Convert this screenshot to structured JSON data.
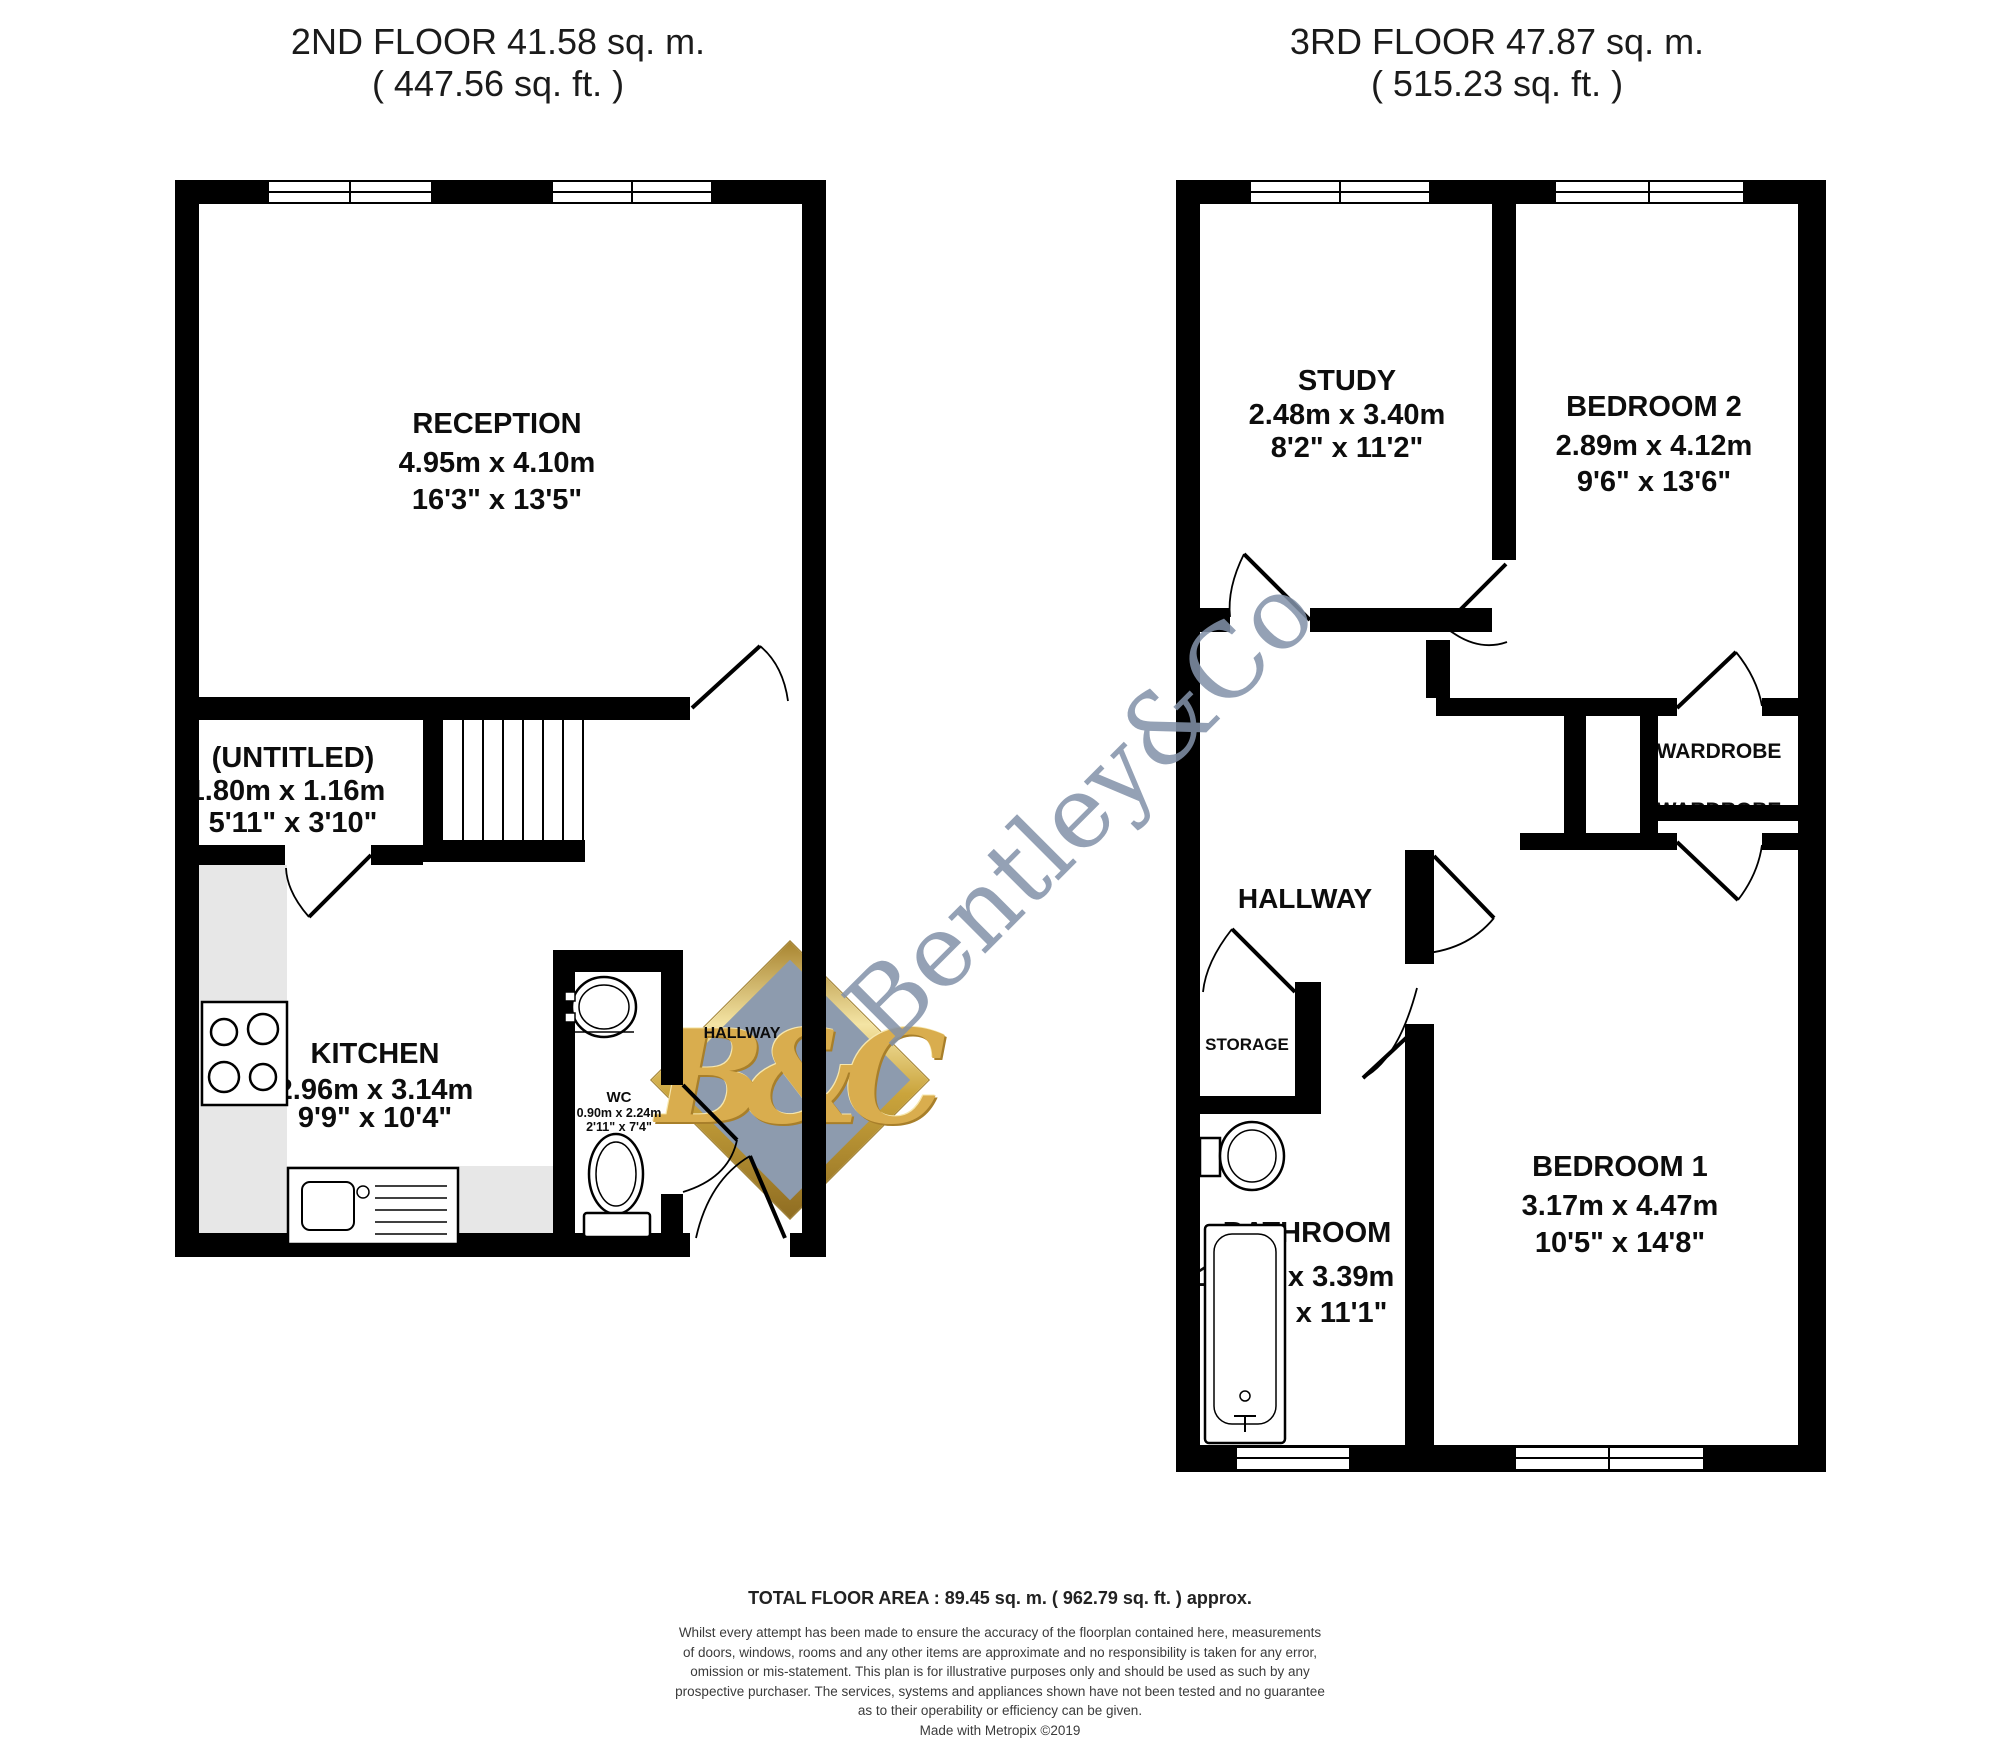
{
  "floor2": {
    "title": "2ND FLOOR 41.58 sq. m.",
    "subtitle": "( 447.56 sq. ft. )",
    "rooms": {
      "reception": {
        "name": "RECEPTION",
        "metric": "4.95m x 4.10m",
        "imperial": "16'3\" x 13'5\""
      },
      "untitled": {
        "name": "(UNTITLED)",
        "metric": "1.80m x 1.16m",
        "imperial": "5'11\" x 3'10\""
      },
      "kitchen": {
        "name": "KITCHEN",
        "metric": "2.96m x 3.14m",
        "imperial": "9'9\" x 10'4\""
      },
      "wc": {
        "name": "WC",
        "metric": "0.90m x 2.24m",
        "imperial": "2'11\" x 7'4\""
      },
      "hallway": {
        "name": "HALLWAY"
      }
    }
  },
  "floor3": {
    "title": "3RD FLOOR 47.87 sq. m.",
    "subtitle": "( 515.23 sq. ft. )",
    "rooms": {
      "study": {
        "name": "STUDY",
        "metric": "2.48m x 3.40m",
        "imperial": "8'2\" x 11'2\""
      },
      "bedroom2": {
        "name": "BEDROOM 2",
        "metric": "2.89m x 4.12m",
        "imperial": "9'6\" x 13'6\""
      },
      "hallway": {
        "name": "HALLWAY"
      },
      "wardrobe1": {
        "name": "WARDROBE"
      },
      "wardrobe2": {
        "name": "WARDROBE"
      },
      "storage": {
        "name": "STORAGE"
      },
      "bathroom": {
        "name": "BATHROOM",
        "metric": "1.78m x 3.39m",
        "imperial": "5'10\" x 11'1\""
      },
      "bedroom1": {
        "name": "BEDROOM 1",
        "metric": "3.17m x 4.47m",
        "imperial": "10'5\" x 14'8\""
      }
    }
  },
  "watermark": {
    "brand": "Bentley&Co",
    "monogram": "B&C",
    "colors": {
      "text": "#8392a9",
      "diamond_fill": "#8d9bae",
      "gold": "#d9ad4e"
    }
  },
  "plan_colors": {
    "wall": "#000000",
    "counter_gray": "#e7e7e7",
    "fixture_stroke": "#000000"
  },
  "footer": {
    "total": "TOTAL FLOOR AREA : 89.45 sq. m. ( 962.79 sq. ft. ) approx.",
    "disclaimer_lines": [
      "Whilst every attempt has been made to ensure the accuracy of the floorplan contained here, measurements",
      "of doors, windows, rooms and any other items are approximate and no responsibility is taken for any error,",
      "omission or mis-statement. This plan is for illustrative purposes only and should be used as such by any",
      "prospective purchaser. The services, systems and appliances shown have not been tested and no guarantee",
      "as to their operability or efficiency can be given."
    ],
    "credit": "Made with Metropix ©2019"
  }
}
